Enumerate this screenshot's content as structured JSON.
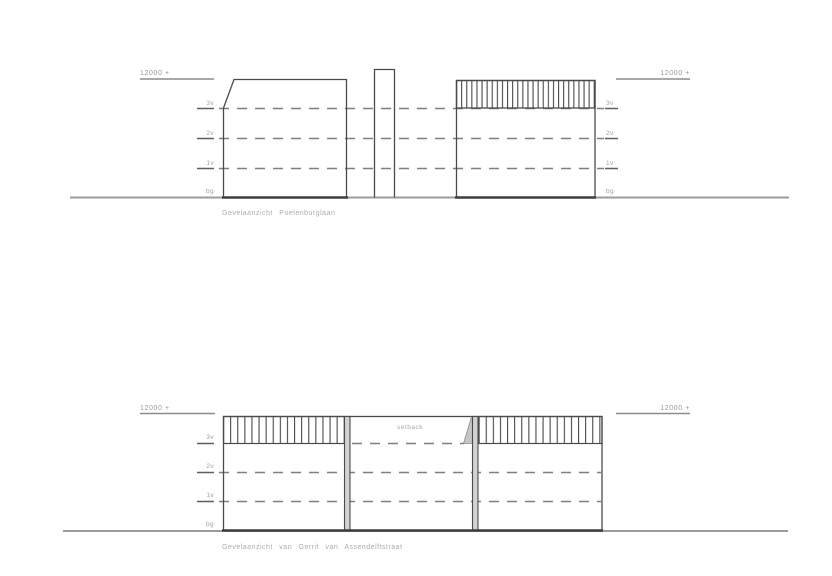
{
  "top_drawing": {
    "caption": "Gevelaanzicht Poelenburglaan",
    "datum_left": "12000 +",
    "datum_right": "12000 +",
    "levels_left": [
      "3v",
      "2v",
      "1v",
      "bg"
    ],
    "levels_right": [
      "3v",
      "2v",
      "1v",
      "bg"
    ]
  },
  "bottom_drawing": {
    "caption": "Gevelaanzicht van Gerrit van Assendelftstraat",
    "datum_left": "12000 +",
    "datum_right": "12000 +",
    "levels_left": [
      "3v",
      "2v",
      "1v",
      "bg"
    ],
    "setback_label": "setback"
  },
  "colors": {
    "outline": "#4a4a4a",
    "ground": "#9b9b9b",
    "dashed_level_line": "#7f7f7f",
    "label_text": "#9e9e9e",
    "party_wall_fill": "#d2d2d2",
    "setback_slope_fill": "#c6c6c6"
  }
}
